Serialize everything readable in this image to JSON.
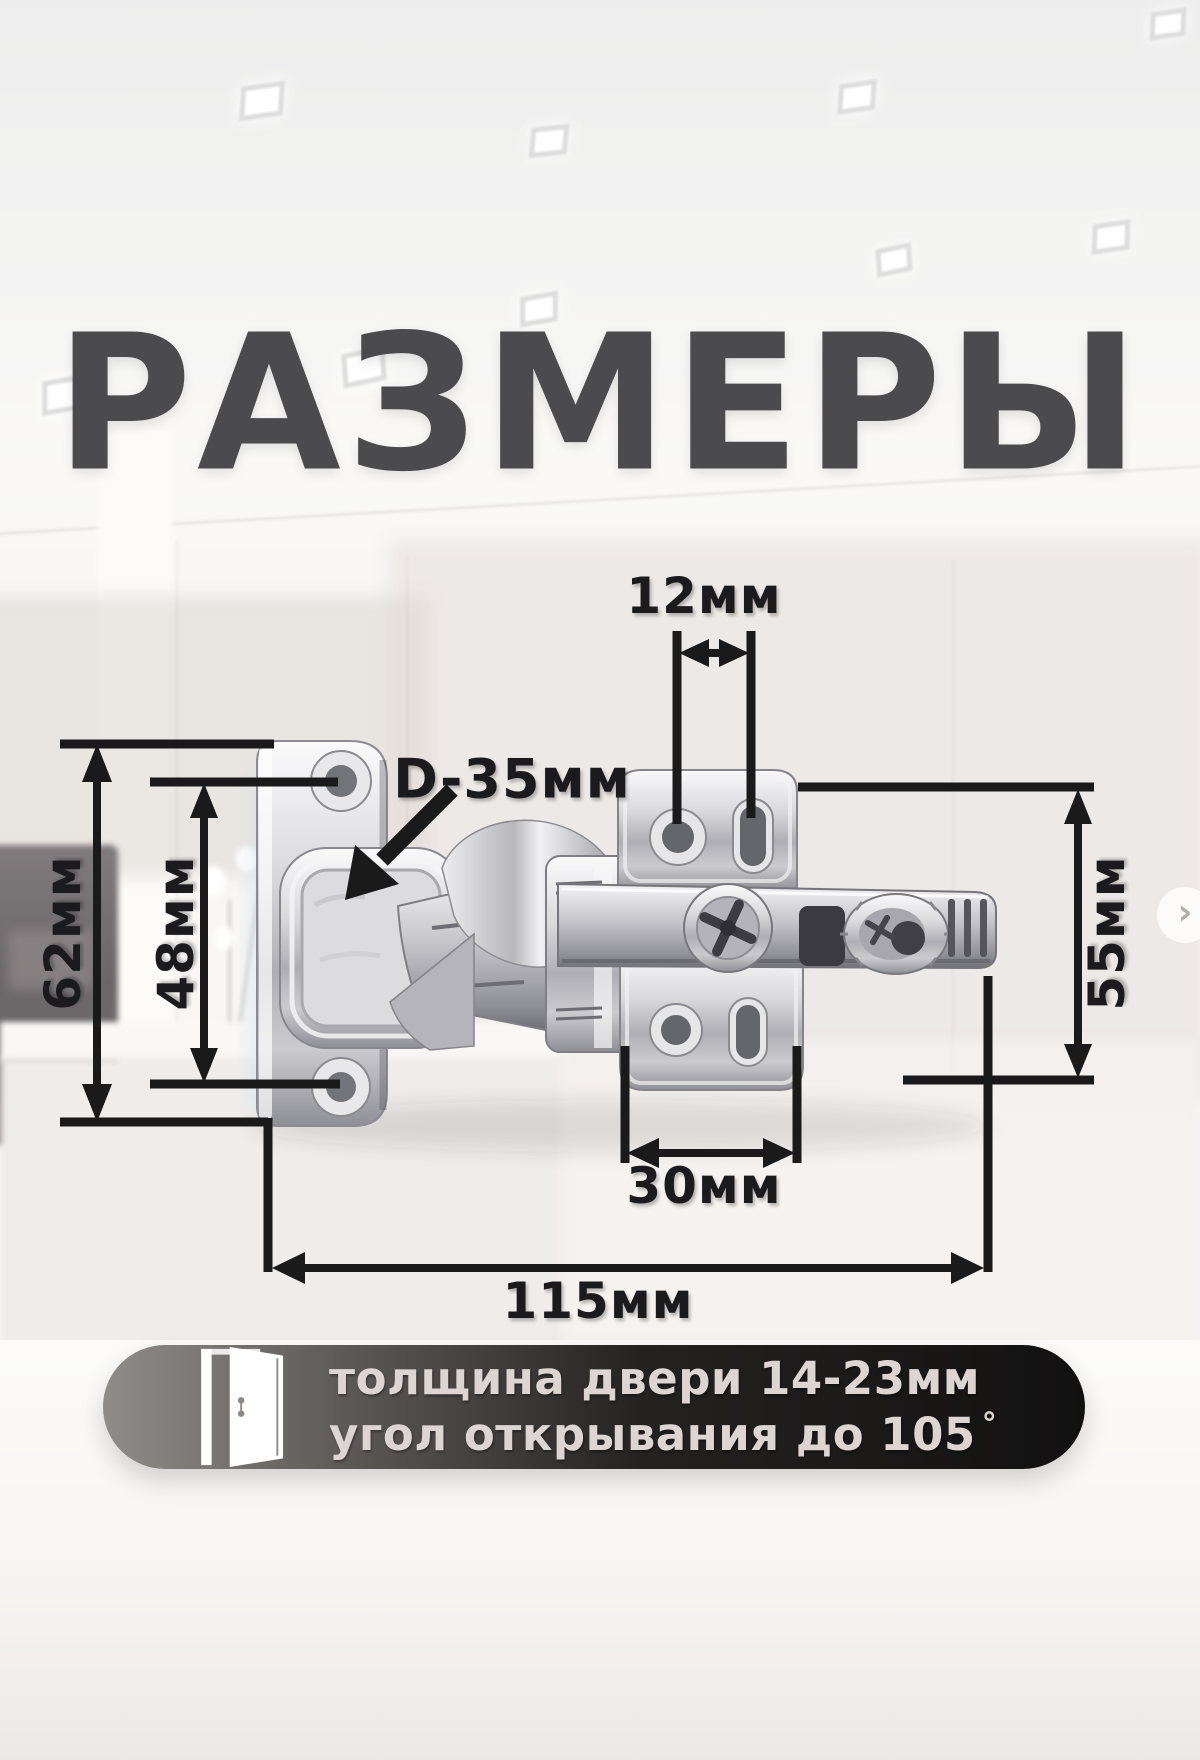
{
  "title": "РАЗМЕРЫ",
  "dimension_labels": {
    "top_hole_spacing": "12мм",
    "cup_diameter": "D-35мм",
    "door_plate_height": "62мм",
    "door_hole_spacing": "48мм",
    "mount_plate_height": "55мм",
    "mount_hole_spacing": "30мм",
    "overall_length": "115мм"
  },
  "specs": {
    "door_thickness": "толщина двери 14-23мм",
    "opening_angle": "угол открывания до 105",
    "degree_symbol": "°"
  },
  "carousel": {
    "next_symbol": "›"
  },
  "colors": {
    "title": "#4b4b4d",
    "dimension_ink": "#1a1a1a",
    "pill_gradient_light": "#908c8a",
    "pill_gradient_dark": "#121111",
    "pill_text": "#ddd5d2",
    "metal_highlight": "#f5f5f7",
    "metal_shadow": "#77777d"
  }
}
